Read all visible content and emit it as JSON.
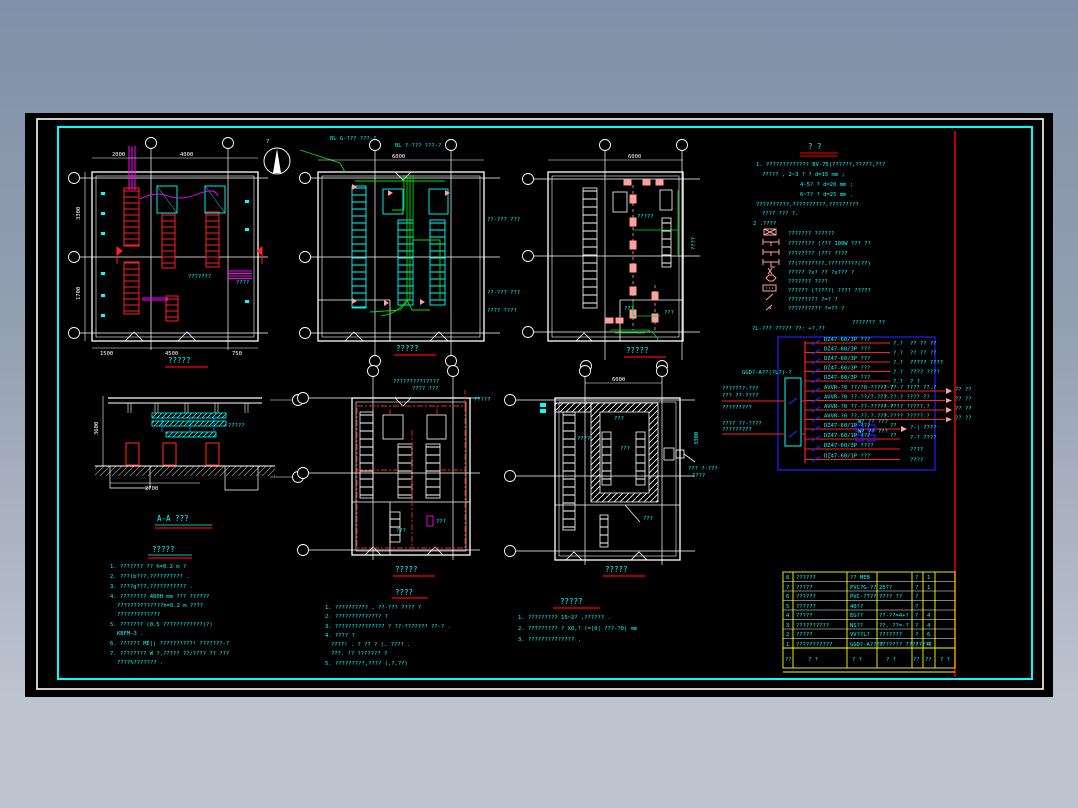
{
  "colors": {
    "canvas": "#000000",
    "frame_inner": "#00ffff",
    "frame_outer": "#ffffff",
    "accent_red": "#ff0000",
    "accent_green": "#00ff00",
    "accent_magenta": "#ff00ff",
    "accent_pink": "#ff9f9f",
    "accent_blue": "#0000ff",
    "table_grid": "#ffff00",
    "text_main": "#00ffff"
  },
  "north": {
    "label": "?"
  },
  "plans": [
    {
      "title": "?????",
      "labels": {
        "dim_t1": "2000",
        "dim_t2": "4000",
        "dim_b1": "1500",
        "dim_b2": "4500",
        "dim_b3": "750",
        "note": "???????",
        "side1": "3300",
        "side2": "1700",
        "cab": "????"
      }
    },
    {
      "title": "?????",
      "labels": {
        "ann1": "BL G-??? ???-?",
        "ann2": "BL ?-??? ???-?",
        "r1": "??-??? ???",
        "r2": "??-??? ???",
        "r3": "???? ????",
        "dim_t": "6000"
      }
    },
    {
      "title": "?????",
      "labels": {
        "dim_t": "6000",
        "lbl1": "?????",
        "lbl2": "???",
        "lbl3": "???",
        "side": "????"
      }
    },
    {
      "title": "A-A  ???",
      "labels": {
        "lbl": "?????",
        "dim_l": "3600",
        "dim_b": "2700"
      }
    },
    {
      "title": "?????",
      "labels": {
        "ann1": "??????????????",
        "ann2": "???? ???",
        "lbl1": "?????",
        "lbl2": "???",
        "lbl3": "???"
      }
    },
    {
      "title": "?????",
      "labels": {
        "dim_t": "6000",
        "lbl1": "????",
        "lbl2": "???",
        "lbl3": "???",
        "lbl4": "??? ?-???",
        "lbl5": "????",
        "side": "3300",
        "lbl6": "???"
      }
    }
  ],
  "notes_main": {
    "title": "?  ?",
    "lines": [
      "1. ????????????? BV-75|??????,?????,???",
      "????? ,    2~3 ? ? d=15 mm ;",
      "4-5? ? d=20 mm ;",
      "6~7? ? d=25 mm .",
      "??????????,??????????,?????????",
      "???? ??? ?.",
      "2 .????"
    ],
    "legend": [
      {
        "t": "???????   ??????"
      },
      {
        "t": "????????  (???   100W ??? ??"
      },
      {
        "t": "????????  (???   ????"
      },
      {
        "t": "??(????????,?????????(??)"
      },
      {
        "t": "?????  ?x? ??    ?x??? ?"
      },
      {
        "t": "???????  ????"
      },
      {
        "t": "?????? (?????)   ???? ?????"
      },
      {
        "t": "?????????    ?=? ?"
      },
      {
        "t": "??????????    ?=?? ?"
      }
    ]
  },
  "diagram": {
    "header1": "?L-??? ?????  ??: +?.??",
    "header2": "??????? ??",
    "box_label": "GGD?-A??(?L?)-?",
    "feeder1": [
      "???????-???",
      "??? ??-????",
      "?????????"
    ],
    "feeder2": [
      "???? ??-????",
      "?????????"
    ],
    "circuits": [
      {
        "l": "DZ47-60/3P ???",
        "r": "?.?",
        "x": "?? ?? ??"
      },
      {
        "l": "DZ47-60/3P ???",
        "r": "?.?",
        "x": "?? ?? ??"
      },
      {
        "l": "DZ47-60/3P ???",
        "r": "?.?",
        "x": "????? ????"
      },
      {
        "l": "DZ47-60/3P ???",
        "r": "?.?",
        "x": "???? ????"
      },
      {
        "l": "DZ47-60/3P ???",
        "r": "?.?",
        "x": "? ?"
      },
      {
        "l": "AVVR-?0 ??/?0-???-? ?",
        "m": "??-??-?  ???? ??.?",
        "r": "?? ??"
      },
      {
        "l": "AVVR-?0 ??-??/?-? ?",
        "m": "??-??-?  ???? ??",
        "r": "?? ??"
      },
      {
        "l": "AVVR-?0 ??-??-???-? ?",
        "m": "??-????  ?????.?",
        "r": "?? ??"
      },
      {
        "l": "AVVR-?0 ??-??-?-? ?",
        "m": "??-????  ?????.?",
        "r": "?? ??"
      },
      {
        "l": "DZ47-60/1P ???",
        "m": "W?  ?? ???",
        "r": "??",
        "x": "?-|  ????"
      },
      {
        "l": "DZ47-60/1P ???",
        "m": "W?  ?? ???",
        "r": "??",
        "x": "?-?  ????"
      },
      {
        "l": "DZ47-60/3P ????",
        "r": "????"
      },
      {
        "l": "DZ47-60/1P ???",
        "r": "????"
      }
    ]
  },
  "notes_install": {
    "title": "?????",
    "lines": [
      "1. ??????? ??   h=0.2 m ?",
      "2. ???(b???,?????????? .",
      "3. ????g???,??????????? .",
      "4. ???????? 400H mm   ??? ??????",
      "??????????????h=0.2 m ????",
      "?????????????",
      "5. ??????? (0.5 ????????????(?)",
      "KBFM-3 .",
      "6. ?????? ME|| ??????????!   ???????-?",
      "7. ????????   W ?,????? ??/???? ??     ???",
      "????%??????? ."
    ]
  },
  "notes_cable": {
    "title": "????",
    "lines": [
      "1. ?????????? ,  ??-??? ???? ?",
      "2. ?????????????? ?",
      "3. ??????????????? ? ??-??????? ??-? .",
      "4. ???? ?",
      "????! .  ?  ?? ?  (. ???? .",
      "???.   ?? ??????? ?",
      "5. ?????????,???? (,?,??)"
    ]
  },
  "notes_floor": {
    "title": "?????",
    "lines": [
      "1. ????????? 15~2? ,?????? .",
      "2. ????????? ? X0,? (=|0|  ???-?0|  mm",
      "3. ?????????????? ."
    ]
  },
  "table": {
    "rows": [
      [
        "8",
        "??????",
        "?? MEB",
        "",
        "?",
        "1",
        ""
      ],
      [
        "7",
        "?????",
        "PVC?G-??",
        "20??",
        "?",
        "1",
        ""
      ],
      [
        "6",
        "??????",
        "PVC-?T??",
        "???? ??",
        "?",
        "",
        ""
      ],
      [
        "5",
        "??????",
        "40??",
        "",
        "?",
        "",
        ""
      ],
      [
        "4",
        "?????",
        "EG??",
        "??-??=4+?",
        "?",
        "4",
        ""
      ],
      [
        "3",
        "??????????",
        "NS??",
        "??. ??=-?",
        "?",
        "4",
        ""
      ],
      [
        "2",
        "?????",
        "VV??L?",
        "???????",
        "?",
        "6",
        ""
      ],
      [
        "1",
        "???????????",
        "GGD?-A????",
        "??????? ????????",
        "?",
        "4",
        ""
      ]
    ],
    "header": [
      "??",
      "? ?",
      "? ?",
      "? ?",
      "??",
      "??",
      "? ?"
    ]
  }
}
